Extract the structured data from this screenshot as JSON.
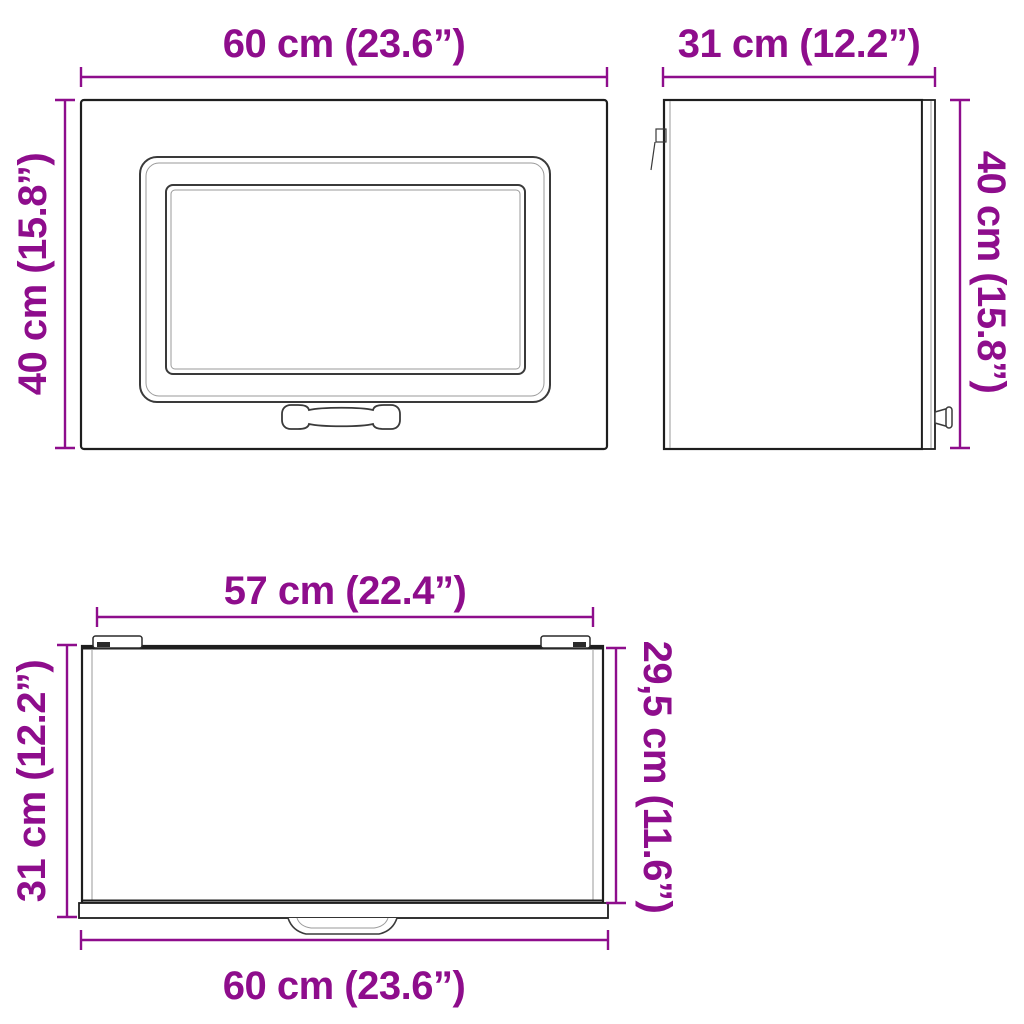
{
  "colors": {
    "dimension_accent": "#8E0D8C",
    "line_dark": "#1e1e1e",
    "line_light": "#9a9a9a",
    "background": "#ffffff"
  },
  "views": {
    "front": {
      "top_dimension": "60 cm (23.6”)",
      "left_dimension": "40 cm (15.8”)"
    },
    "side": {
      "top_dimension": "31 cm (12.2”)",
      "right_dimension": "40 cm (15.8”)"
    },
    "top": {
      "top_dimension": "57 cm (22.4”)",
      "left_dimension": "31 cm (12.2”)",
      "right_dimension": "29,5 cm (11.6”)",
      "bottom_dimension": "60 cm (23.6”)"
    }
  }
}
